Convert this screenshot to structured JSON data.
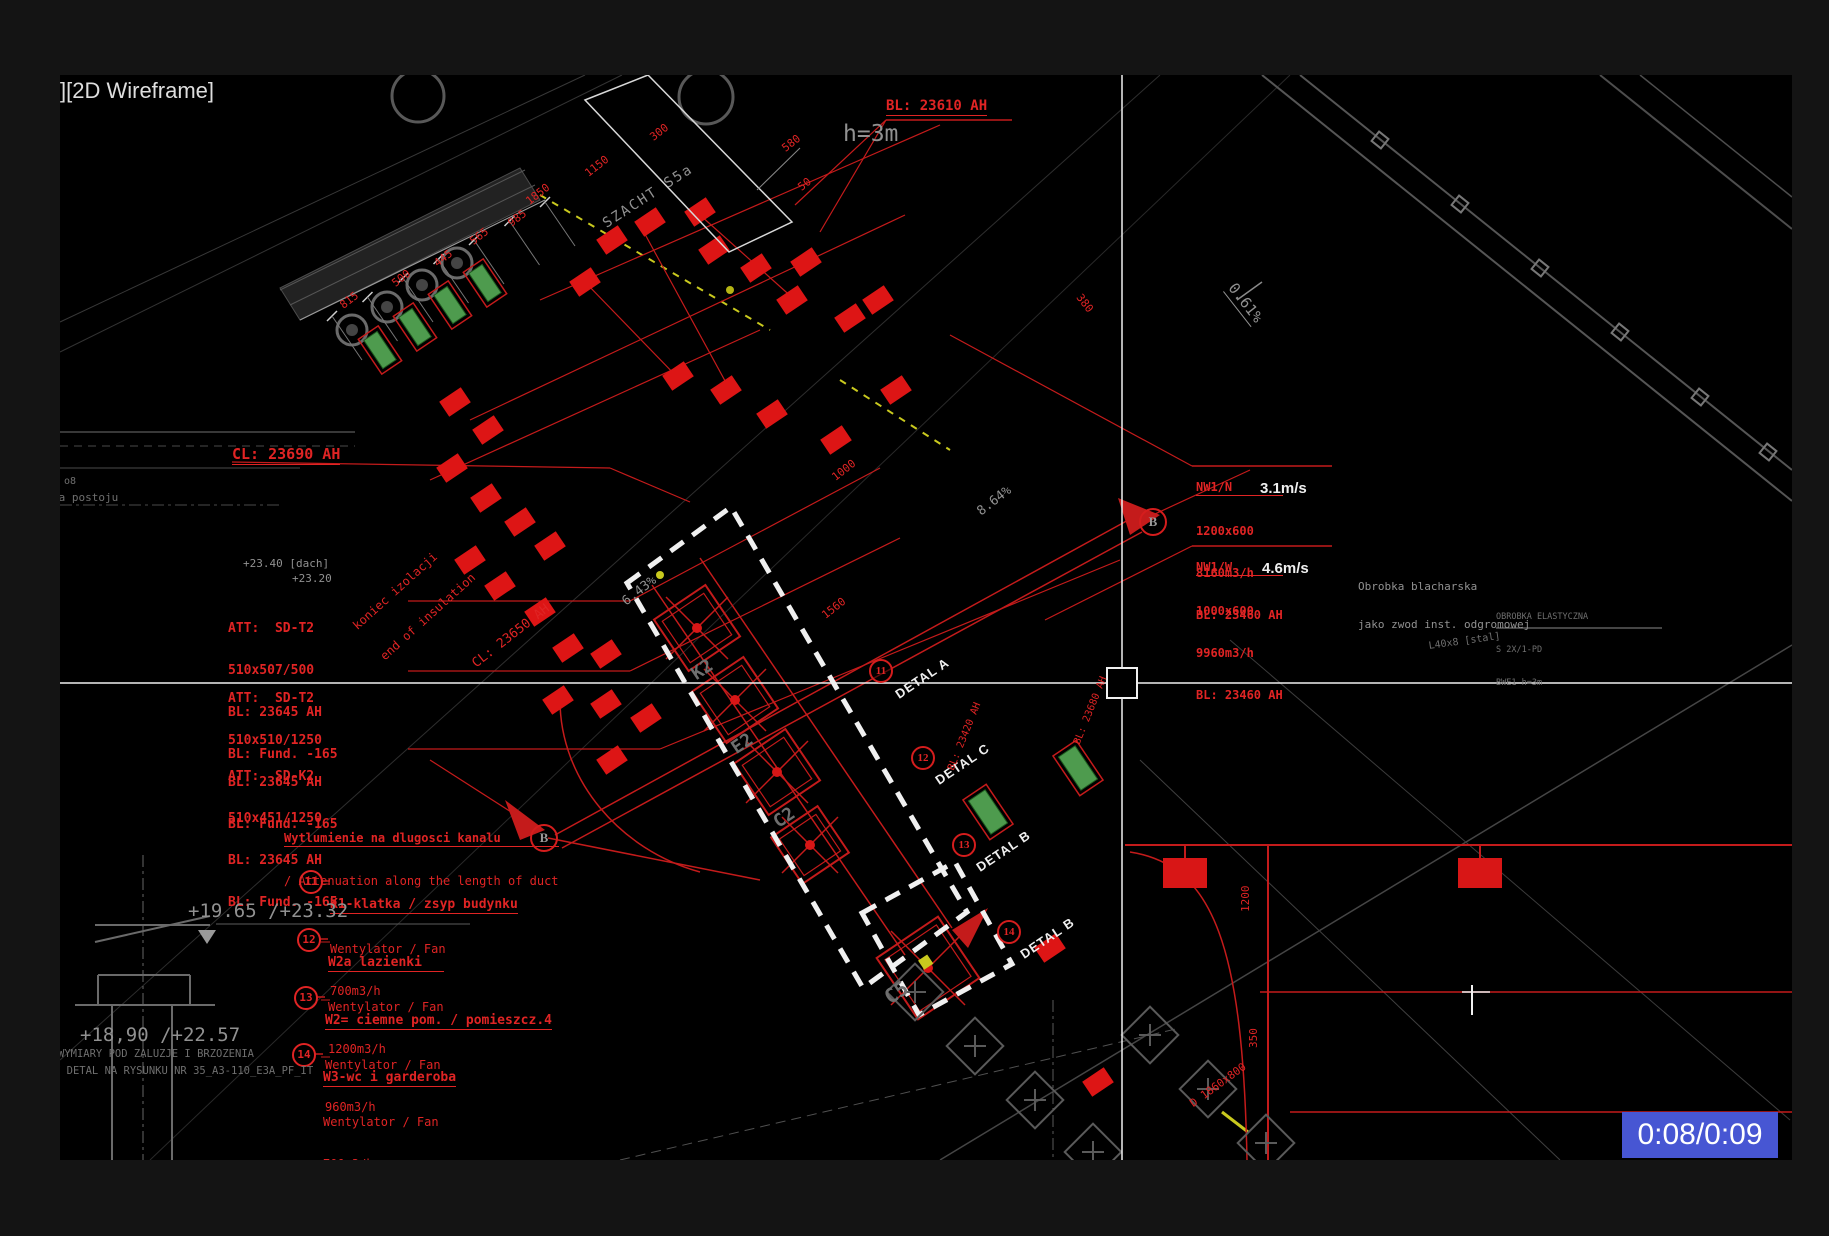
{
  "viewport": {
    "label": "][2D Wireframe]"
  },
  "player": {
    "time": "0:08/0:09",
    "bar_color": "#4756d3"
  },
  "colors": {
    "red": "#e02424",
    "gray": "#919191",
    "green": "#4e9b4e",
    "yellow": "#c9c91e",
    "white": "#efefef",
    "canvas": "#000000"
  },
  "labels": {
    "bl_top": "BL: 23610 AH",
    "h3m": "h=3m",
    "cl_main": "CL: 23690 AH",
    "cl_duct": "CL: 23650 AH",
    "end_insulation_1": "koniec izolacji",
    "end_insulation_2": "end of insulation",
    "roof1": "+23.40 [dach]",
    "roof2": "+23.20",
    "shaft": "SZACHT S5a",
    "slope_061": "0.61%",
    "slope_864": "8.64%",
    "slope_643": "6.43%",
    "sheet_metal_1": "Obrobka blacharska",
    "sheet_metal_2": "jako zwod inst. odgromowej",
    "small_note_1": "OBROBKA ELASTYCZNA",
    "small_note_2": "S 2X/1-PD",
    "small_note_3": "BWE1 h=3m",
    "steel": "L40x8 [stal]",
    "level_a": "+19.65 /+23.32",
    "level_b": "+18,90 /+22.57",
    "caption_1": "WYMIARY POD ZALUZJE I BRZOZENIA",
    "caption_2": "Y DETAL NA RYSUNKU NR 35_A3-110_E3A_PF_IT",
    "na_postoju": "na postoju",
    "o8": "o8",
    "attenuation_1": "Wytlumienie na dlugosci kanalu",
    "attenuation_2": "/ Attenuation along the length of duct",
    "duct_d": "D 1860x800",
    "marker_b": "B"
  },
  "att_blocks": [
    {
      "l1": "ATT:  SD-T2",
      "l2": "510x507/500",
      "l3": "BL: 23645 AH",
      "l4": "BL: Fund. -165"
    },
    {
      "l1": "ATT:  SD-T2",
      "l2": "510x510/1250",
      "l3": "BL: 23645 AH",
      "l4": "BL: Fund. -165"
    },
    {
      "l1": "ATT:  SD-K2",
      "l2": "510x451/1250",
      "l3": "BL: 23645 AH",
      "l4": "BL: Fund. -165"
    }
  ],
  "fan_items": [
    {
      "num": "11",
      "title": "K1-klatka / zsyp budynku",
      "line": "Wentylator / Fan",
      "flow": "700m3/h"
    },
    {
      "num": "12",
      "title": "W2a lazienki",
      "line": "Wentylator / Fan",
      "flow": "1200m3/h"
    },
    {
      "num": "13",
      "title": "W2= ciemne pom. / pomieszcz.4",
      "line": "Wentylator / Fan",
      "flow": "960m3/h"
    },
    {
      "num": "14",
      "title": "W3-wc i garderoba",
      "line": "Wentylator / Fan",
      "flow": "700m3/h"
    }
  ],
  "flow_blocks": [
    {
      "title": "NW1/N",
      "size": "1200x600",
      "flow": "8160m3/h",
      "vel": "3.1m/s",
      "bl": "BL: 23460 AH"
    },
    {
      "title": "NW1/W",
      "size": "1000x600",
      "flow": "9960m3/h",
      "vel": "4.6m/s",
      "bl": "BL: 23460 AH"
    }
  ],
  "details": [
    {
      "num": "11",
      "label": "DETAL A"
    },
    {
      "num": "12",
      "label": "DETAL C"
    },
    {
      "num": "13",
      "label": "DETAL B"
    },
    {
      "num": "14",
      "label": "DETAL B"
    }
  ],
  "equip_labels": [
    "K2",
    "E2",
    "C2",
    "C5"
  ],
  "dims": {
    "string1": [
      "815",
      "500",
      "445",
      "565",
      "985",
      "1850"
    ],
    "top": [
      "1150",
      "300",
      "580",
      "50"
    ],
    "misc": [
      "1560",
      "1000",
      "380",
      "1200",
      "350"
    ]
  },
  "bl_mid": [
    "BL: 23420 AH",
    "BL: 23680 AH"
  ]
}
